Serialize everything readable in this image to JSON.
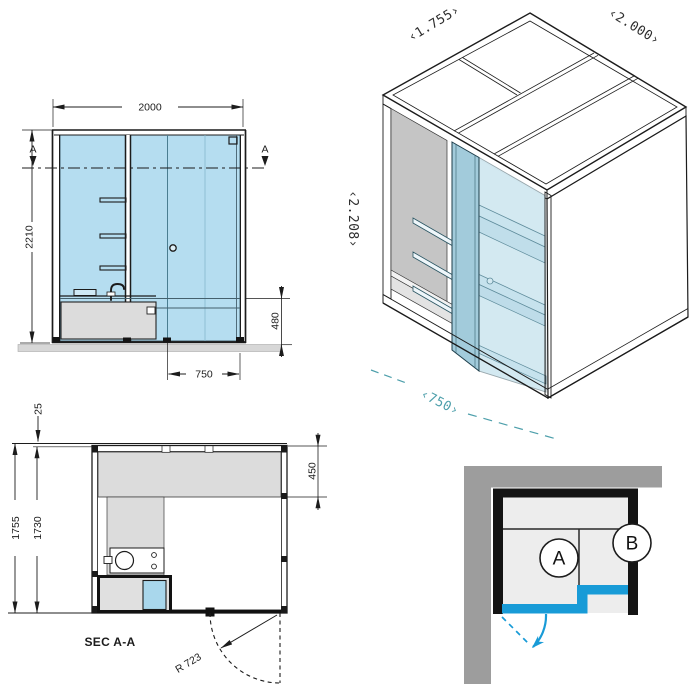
{
  "colors": {
    "accent_blue": "#189bd7",
    "teal_accent": "#4d9fab",
    "glass_blue": "#b5ddf0",
    "wall_gray": "#9d9d9d"
  },
  "elevation": {
    "width": "2000",
    "height": "2210",
    "sill_height": "480",
    "door_width": "750",
    "section_marker": "A"
  },
  "isometric": {
    "depth_label": "‹1.755›",
    "width_label": "‹2.000›",
    "height_label": "‹2.208›",
    "door_label": "‹750›"
  },
  "plan": {
    "title": "SEC A-A",
    "roof_overhang": "25",
    "outer_depth": "1755",
    "inner_depth": "1730",
    "bench_depth": "450",
    "door_swing_radius": "R 723"
  },
  "context": {
    "zone_a": "A",
    "zone_b": "B"
  }
}
